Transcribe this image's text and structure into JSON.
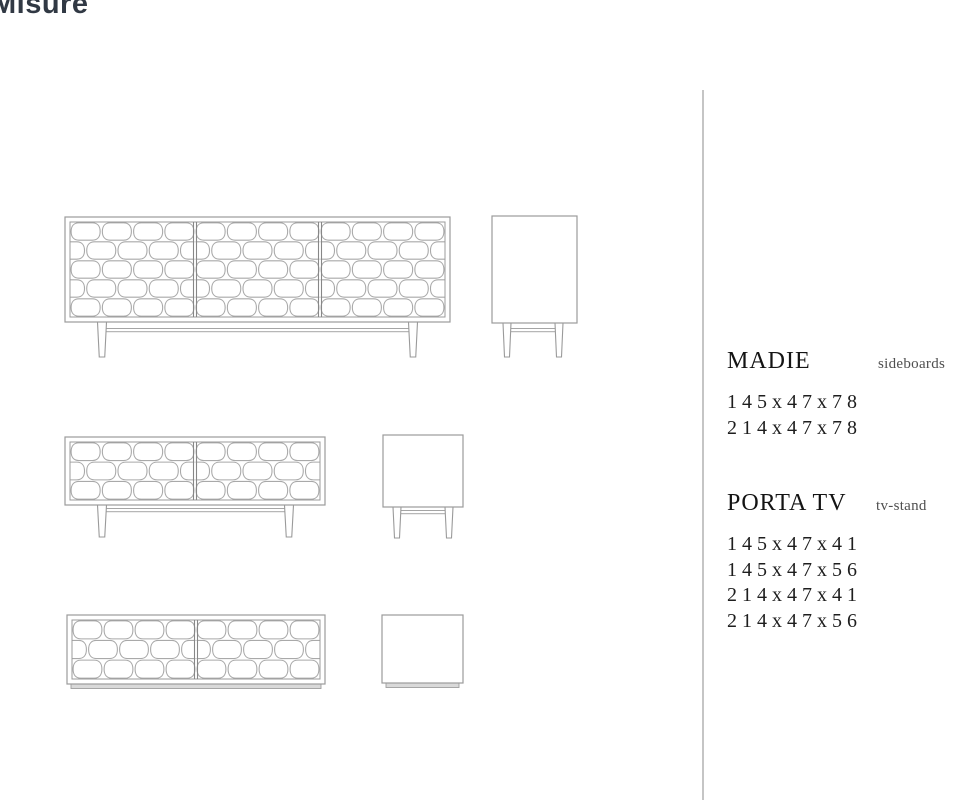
{
  "page": {
    "title": "Misure"
  },
  "specs": {
    "madie": {
      "name": "MADIE",
      "type_label": "sideboards",
      "dimensions": [
        "145x47x78",
        "214x47x78"
      ]
    },
    "porta_tv": {
      "name": "PORTA TV",
      "type_label": "tv-stand",
      "dimensions": [
        "145x47x41",
        "145x47x56",
        "214x47x41",
        "214x47x56"
      ]
    }
  },
  "drawings": {
    "sideboard_front": "sideboard front view, 3 doors, honeycomb pattern, legs",
    "sideboard_side": "sideboard side view, legs",
    "tvstand_legs_front": "tv-stand front view, 2 doors, honeycomb pattern, legs",
    "tvstand_legs_side": "tv-stand side view, legs",
    "tvstand_plinth_front": "tv-stand front view, 2 doors, honeycomb pattern, plinth base",
    "tvstand_plinth_side": "tv-stand side view, plinth base"
  },
  "colors": {
    "title": "#313944",
    "line_art": "#a9a9a9",
    "divider_rule": "#c5c5c5",
    "spec_text": "#141414"
  }
}
